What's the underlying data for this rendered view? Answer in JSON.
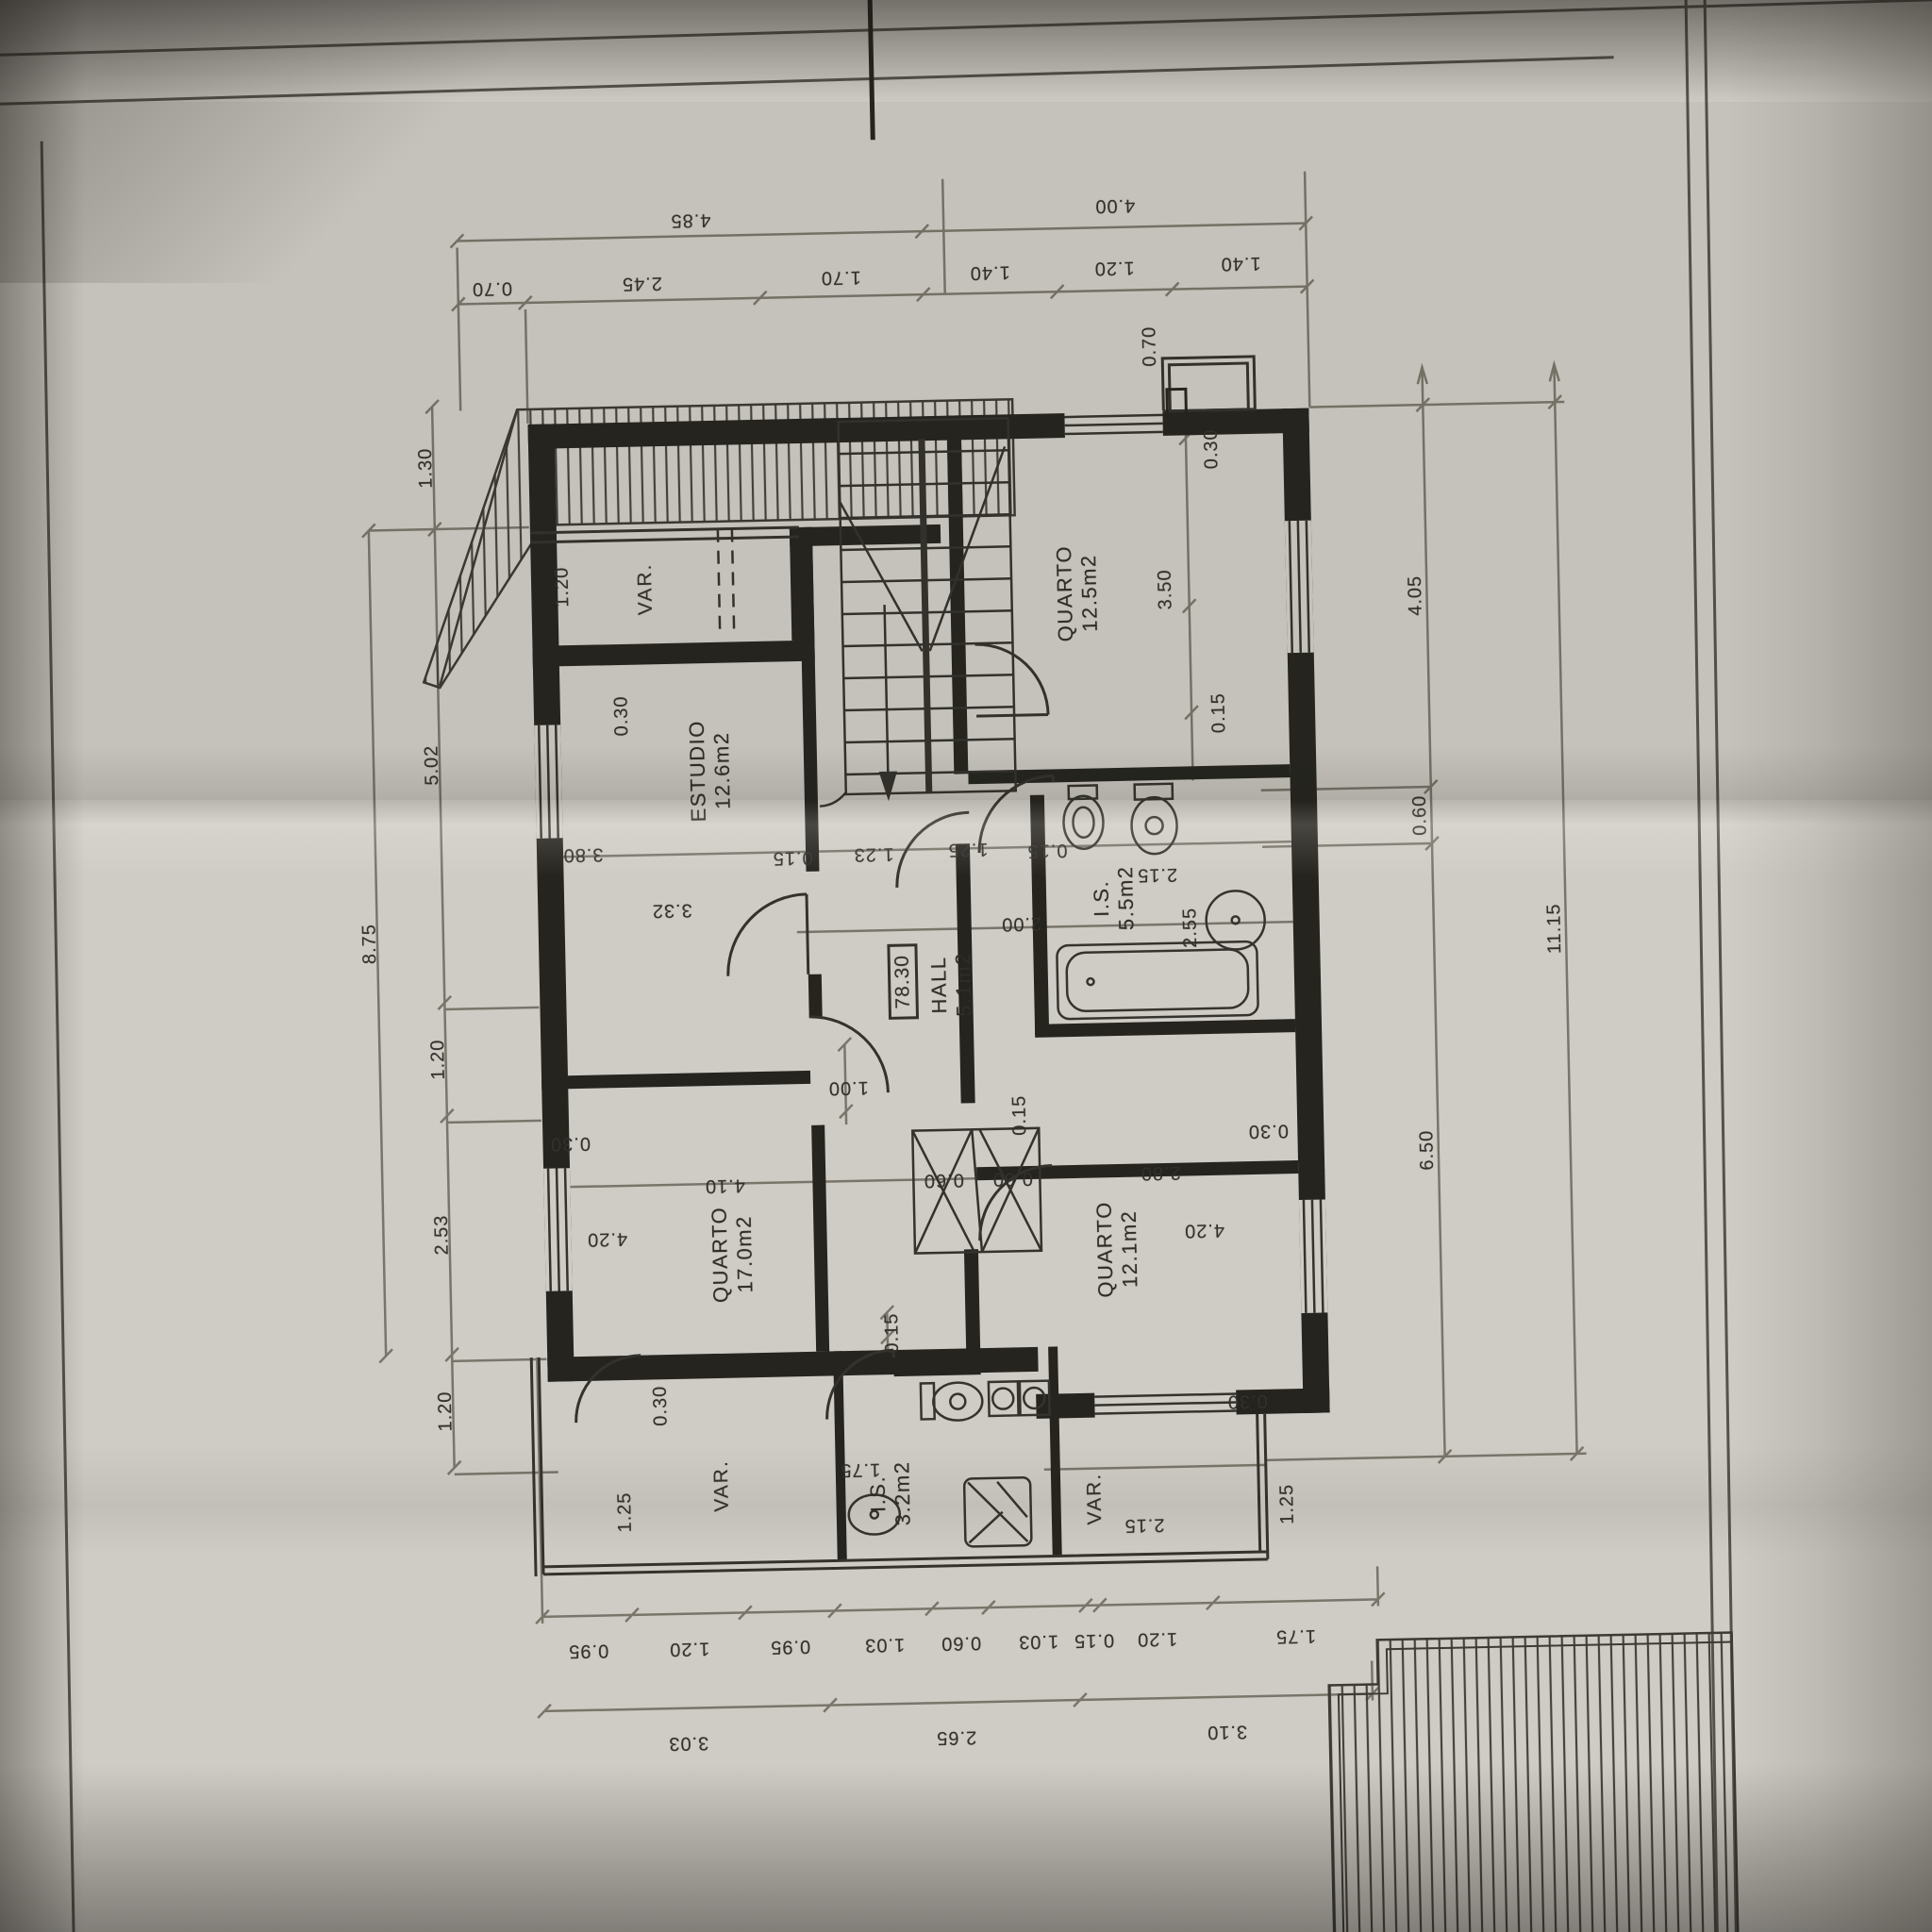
{
  "sheet": {
    "corner_letter": "E",
    "paper_color": "#cfccc5",
    "line_color": "#26241f"
  },
  "level_mark": "78.30",
  "rooms": [
    {
      "name": "QUARTO",
      "area": "12.5m2"
    },
    {
      "name": "ESTUDIO",
      "area": "12.6m2"
    },
    {
      "name": "HALL",
      "area": "5.1m2"
    },
    {
      "name": "I.S.",
      "area": "5.5m2"
    },
    {
      "name": "QUARTO",
      "area": "17.0m2"
    },
    {
      "name": "QUARTO",
      "area": "12.1m2"
    },
    {
      "name": "I.S.",
      "area": "3.2m2"
    }
  ],
  "var_labels": [
    "VAR.",
    "VAR.",
    "VAR."
  ],
  "dims": {
    "top1": [
      "4.85",
      "4.00"
    ],
    "top2": [
      "0.70",
      "2.45",
      "1.70",
      "1.40",
      "1.20",
      "1.40"
    ],
    "bottom1": [
      "0.95",
      "1.20",
      "0.95",
      "1.03",
      "0.60",
      "1.03",
      "0.15",
      "1.20",
      "1.75"
    ],
    "bottom2": [
      "3.03",
      "2.65",
      "3.10"
    ],
    "left_outer": [
      "8.75"
    ],
    "left_inner": [
      "1.30",
      "5.02",
      "1.20",
      "2.53",
      "1.20"
    ],
    "right_inner": [
      "4.05",
      "0.60",
      "6.50"
    ],
    "right_outer": [
      "11.15"
    ],
    "interior": [
      "0.70",
      "0.30",
      "3.50",
      "0.15",
      "1.20",
      "0.30",
      "3.80",
      "0.15",
      "1.23",
      "1.25",
      "0.15",
      "2.15",
      "3.32",
      "2.00",
      "2.55",
      "1.00",
      "0.15",
      "0.30",
      "0.30",
      "4.20",
      "4.10",
      "0.60",
      "0.60",
      "2.80",
      "4.20",
      "0.15",
      "0.30",
      "0.30",
      "1.75",
      "1.25",
      "2.15",
      "1.25"
    ]
  }
}
